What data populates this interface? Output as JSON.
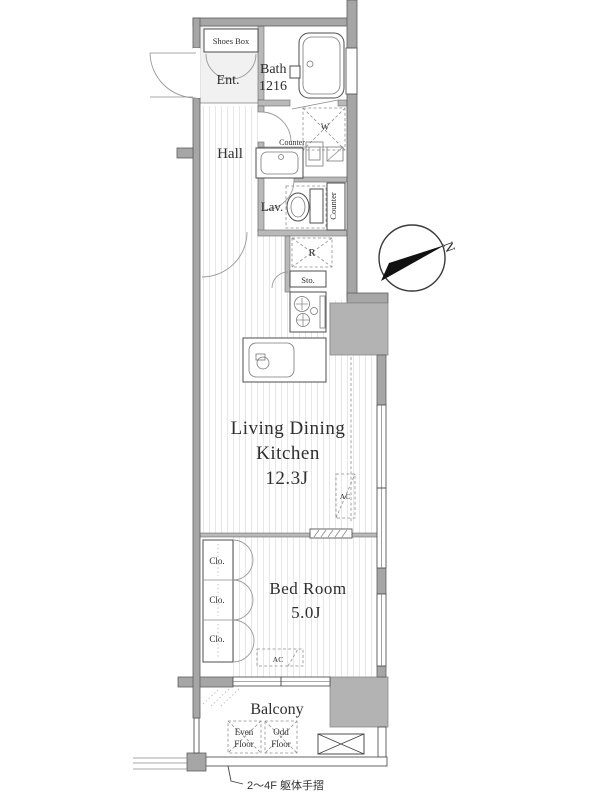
{
  "title": "Apartment floor plan",
  "rooms": {
    "shoes_box": "Shoes Box",
    "entrance": "Ent.",
    "bath": {
      "line1": "Bath",
      "line2": "1216"
    },
    "hall": "Hall",
    "counter_top": "Counter",
    "washer": "W",
    "lavatory": "Lav.",
    "counter_side": "Counter",
    "refrigerator": "R",
    "storage": "Sto.",
    "ldk": {
      "line1": "Living Dining",
      "line2": "Kitchen",
      "size": "12.3J"
    },
    "ac_ldk": "AC",
    "bedroom": {
      "line1": "Bed Room",
      "size": "5.0J"
    },
    "ac_bedroom": "AC",
    "closets": {
      "c1": "Clo.",
      "c2": "Clo.",
      "c3": "Clo."
    },
    "balcony": "Balcony",
    "even_floor": {
      "line1": "Even",
      "line2": "Floor"
    },
    "odd_floor": {
      "line1": "Odd",
      "line2": "Floor"
    }
  },
  "compass": {
    "north_label": "N"
  },
  "notes": {
    "handrail": "2〜4F 躯体手摺"
  },
  "colors": {
    "wall": "#a6a6a6",
    "shaft": "#b3b3b3",
    "floor_stripe": "#e7e7e7",
    "line": "#555555",
    "text": "#2e2e2e"
  }
}
